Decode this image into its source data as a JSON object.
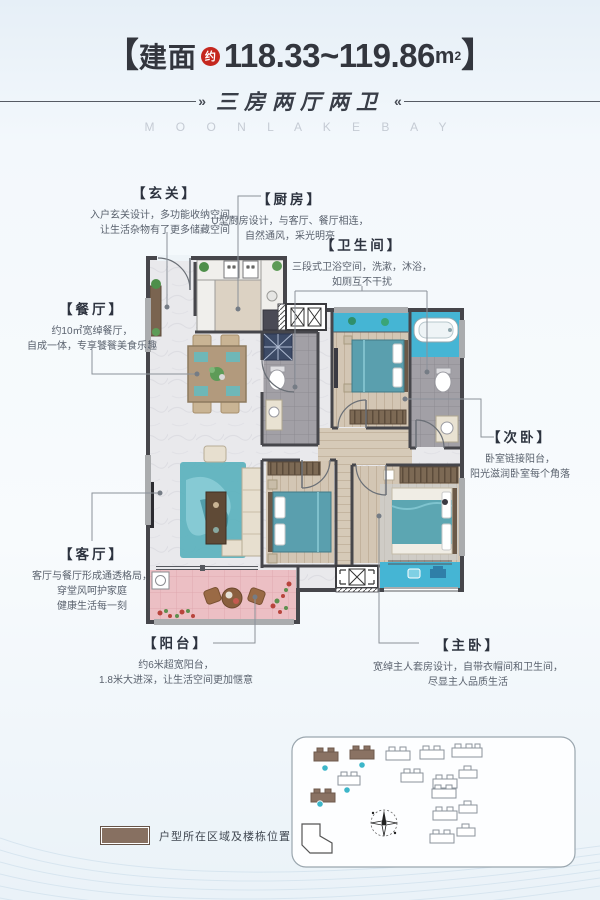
{
  "header": {
    "area_prefix_bracket": "【",
    "area_prefix": "建面",
    "area_approx_badge": "约",
    "area_value": "118.33~119.86",
    "area_unit_base": "m",
    "area_unit_sup": "2",
    "area_suffix_bracket": "】",
    "subtitle": "三房两厅两卫",
    "subtitle_left_mark": "»",
    "subtitle_right_mark": "«",
    "english_title": "M O O N L A K E B A Y"
  },
  "callouts": [
    {
      "id": "entry",
      "label": "【玄关】",
      "lines": [
        "入户玄关设计，多功能收纳空间，",
        "让生活杂物有了更多储藏空间"
      ]
    },
    {
      "id": "kitchen",
      "label": "【厨房】",
      "lines": [
        "U型厨房设计，与客厅、餐厅相连，",
        "自然通风，采光明亮"
      ]
    },
    {
      "id": "bathroom",
      "label": "【卫生间】",
      "lines": [
        "三段式卫浴空间，洗漱，沐浴，",
        "如厕互不干扰"
      ]
    },
    {
      "id": "dining",
      "label": "【餐厅】",
      "lines": [
        "约10㎡宽绰餐厅，",
        "自成一体，专享饕餮美食乐趣"
      ]
    },
    {
      "id": "second-bed",
      "label": "【次卧】",
      "lines": [
        "卧室链接阳台，",
        "阳光滋润卧室每个角落"
      ]
    },
    {
      "id": "living",
      "label": "【客厅】",
      "lines": [
        "客厅与餐厅形成通透格局，",
        "穿堂风呵护家庭",
        "健康生活每一刻"
      ]
    },
    {
      "id": "balcony",
      "label": "【阳台】",
      "lines": [
        "约6米超宽阳台，",
        "1.8米大进深，让生活空间更加惬意"
      ]
    },
    {
      "id": "master-bed",
      "label": "【主卧】",
      "lines": [
        "宽绰主人套房设计，自带衣帽间和卫生间，",
        "尽显主人品质生活"
      ]
    }
  ],
  "legend": {
    "text": "户型所在区域及楼栋位置",
    "swatch_color": "#877061"
  },
  "site_plan": {
    "buildings_total": 14,
    "highlighted_buildings": 3,
    "marker_count": 4,
    "marker_color": "#3db6c9"
  },
  "colors": {
    "accent_red": "#c5271e",
    "title_text": "#33363e",
    "teal_floor": "#45b5d4",
    "teal_furniture": "#5a9fae",
    "pink_balcony": "#ecbfc4",
    "wall": "#46464b",
    "legend_brown": "#877061",
    "background_blue": "#e6eff7"
  }
}
